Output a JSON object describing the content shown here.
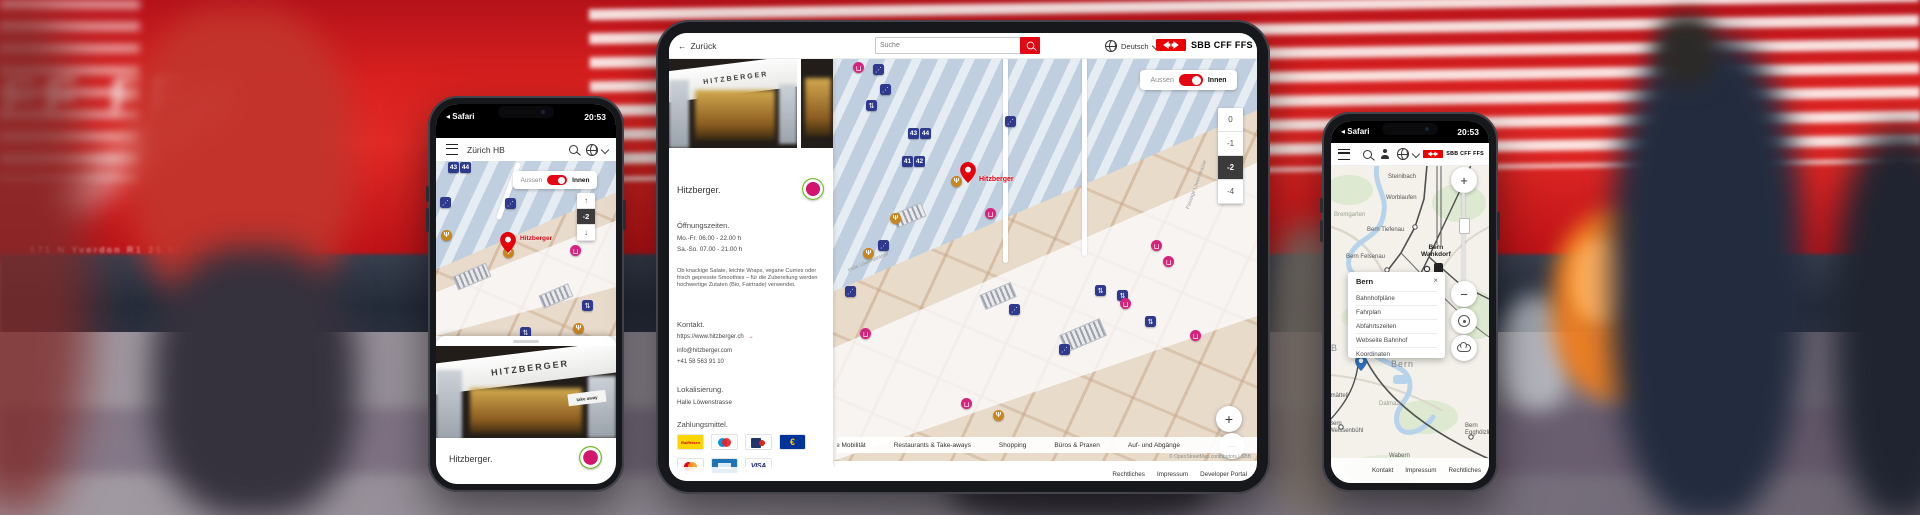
{
  "glyphs": {
    "back": "←",
    "arrow": "→",
    "up": "↑",
    "down": "↓",
    "plus": "+",
    "minus": "−",
    "close": "×",
    "status_back": "◂"
  },
  "background": {
    "train_letters": "FF FF",
    "train_label": "571 N Yverdon R1 25.02.13"
  },
  "phone_left": {
    "status": {
      "app": "Safari",
      "time": "20:53"
    },
    "header": {
      "title": "Zürich HB"
    },
    "map": {
      "toggle_off": "Aussen",
      "toggle_on": "Innen",
      "floor": "-2",
      "pin": "Hitzberger",
      "signs": [
        {
          "v": "43"
        },
        {
          "v": "44"
        }
      ],
      "icons": [
        {
          "type": "esc",
          "x": 4,
          "y": 36
        },
        {
          "type": "esc",
          "x": 69,
          "y": 37
        },
        {
          "type": "resto",
          "x": 5,
          "y": 69
        },
        {
          "type": "resto",
          "x": 67,
          "y": 86
        },
        {
          "type": "shop",
          "x": 134,
          "y": 84
        },
        {
          "type": "lift",
          "x": 146,
          "y": 139
        },
        {
          "type": "resto",
          "x": 137,
          "y": 162
        },
        {
          "type": "lift",
          "x": 84,
          "y": 166
        }
      ]
    },
    "sheet": {
      "sign": "HITZBERGER",
      "tag": "take away",
      "title": "Hitzberger."
    }
  },
  "tablet": {
    "toolbar": {
      "back": "Zurück",
      "search_placeholder": "Suche",
      "language": "Deutsch",
      "logo": "SBB CFF FFS"
    },
    "panel": {
      "sign": "HITZBERGER",
      "title": "Hitzberger.",
      "open_heading": "Öffnungszeiten.",
      "hours": [
        {
          "label": "Mo.-Fr. 06.00 - 22.00 h"
        },
        {
          "label": "Sa.-So. 07.00 - 21.00 h"
        }
      ],
      "description": "Ob knackige Salate, leichte Wraps, vegane Curries oder frisch gepresste Smoothies – für die Zubereitung werden hochwertige Zutaten (Bio, Fairtrade) verwendet.",
      "contact_heading": "Kontakt.",
      "website": "https://www.hitzberger.ch",
      "email": "info@hitzberger.com",
      "phone": "+41 58 563 91 10",
      "location_heading": "Lokalisierung.",
      "location": "Halle Löwenstrasse",
      "payment_heading": "Zahlungsmittel.",
      "payments_row1": [
        {
          "type": "raiffeisen",
          "sym": "Raiffeisen",
          "name": "Raiffeisen"
        },
        {
          "type": "maestro",
          "name": "Maestro"
        },
        {
          "type": "lunchcheck",
          "name": "Lunch-Check"
        },
        {
          "type": "eur",
          "sym": "€",
          "name": "EUR"
        }
      ],
      "payments_row2": [
        {
          "type": "mastercard",
          "name": "Mastercard"
        },
        {
          "type": "amex",
          "name": "American Express"
        },
        {
          "type": "visa",
          "sym": "VISA",
          "name": "VISA"
        }
      ]
    },
    "map": {
      "toggle_off": "Aussen",
      "toggle_on": "Innen",
      "floors": [
        {
          "v": "0"
        },
        {
          "v": "-1"
        },
        {
          "v": "-2",
          "cls": "active"
        },
        {
          "v": "-4"
        }
      ],
      "signs_a": [
        {
          "v": "43"
        },
        {
          "v": "44"
        }
      ],
      "signs_b": [
        {
          "v": "41"
        },
        {
          "v": "42"
        }
      ],
      "pin": "Hitzberger",
      "streets": [
        {
          "text": "Passage Löwenstrasse",
          "x": 352,
          "y": 150,
          "rot": -70
        },
        {
          "text": "Halle Löwenstrasse",
          "x": 14,
          "y": 210,
          "rot": -23
        }
      ],
      "icons": [
        {
          "type": "shop",
          "x": 20,
          "y": 4
        },
        {
          "type": "esc",
          "x": 40,
          "y": 6
        },
        {
          "type": "esc",
          "x": 47,
          "y": 26
        },
        {
          "type": "lift",
          "x": 33,
          "y": 42
        },
        {
          "type": "esc",
          "x": 172,
          "y": 58
        },
        {
          "type": "resto",
          "x": 118,
          "y": 118
        },
        {
          "type": "resto",
          "x": 57,
          "y": 155
        },
        {
          "type": "resto",
          "x": 30,
          "y": 190
        },
        {
          "type": "shop",
          "x": 152,
          "y": 150
        },
        {
          "type": "esc",
          "x": 45,
          "y": 182
        },
        {
          "type": "esc",
          "x": 12,
          "y": 228
        },
        {
          "type": "shop",
          "x": 318,
          "y": 182
        },
        {
          "type": "shop",
          "x": 330,
          "y": 198
        },
        {
          "type": "lift",
          "x": 262,
          "y": 227
        },
        {
          "type": "lift",
          "x": 284,
          "y": 232
        },
        {
          "type": "shop",
          "x": 287,
          "y": 240
        },
        {
          "type": "lift",
          "x": 312,
          "y": 258
        },
        {
          "type": "esc",
          "x": 176,
          "y": 246
        },
        {
          "type": "esc",
          "x": 226,
          "y": 286
        },
        {
          "type": "shop",
          "x": 357,
          "y": 272
        },
        {
          "type": "shop",
          "x": 27,
          "y": 270
        },
        {
          "type": "shop",
          "x": 128,
          "y": 340
        },
        {
          "type": "resto",
          "x": 160,
          "y": 352
        }
      ],
      "legend": [
        {
          "label": "Kombinierte Mobilität",
          "type": "mobility",
          "cls": "clip"
        },
        {
          "label": "Restaurants & Take-aways",
          "type": "resto"
        },
        {
          "label": "Shopping",
          "type": "shop"
        },
        {
          "label": "Büros & Praxen",
          "type": "office"
        },
        {
          "label": "Auf- und Abgänge",
          "type": "stairs"
        }
      ],
      "attribution": "© OpenStreetMap contributors | SBB",
      "footer": [
        {
          "label": "Rechtliches"
        },
        {
          "label": "Impressum"
        },
        {
          "label": "Developer Portal"
        }
      ]
    }
  },
  "phone_right": {
    "status": {
      "app": "Safari",
      "time": "20:53"
    },
    "header": {
      "logo": "SBB CFF FFS"
    },
    "map": {
      "labels": [
        {
          "text": "Steinibach",
          "x": 57,
          "y": 9
        },
        {
          "text": "Worblaufen",
          "x": 55,
          "y": 30
        },
        {
          "text": "Bremgarten",
          "x": 3,
          "y": 47,
          "cls": "dim"
        },
        {
          "text": "Bern Tiefenau",
          "x": 36,
          "y": 62
        },
        {
          "text": "Bern Felsenau",
          "x": 15,
          "y": 89
        },
        {
          "text": "Bern\nWankdorf",
          "x": 90,
          "y": 79,
          "cls": "bold"
        },
        {
          "text": "B",
          "x": 0,
          "y": 180,
          "cls": "big"
        },
        {
          "text": "Bern",
          "x": 60,
          "y": 196,
          "cls": "big"
        },
        {
          "text": "Fischermätteli",
          "x": -20,
          "y": 228
        },
        {
          "text": "Dalmazi",
          "x": 48,
          "y": 236,
          "cls": "dim"
        },
        {
          "text": "Bern\nWeissenbühl",
          "x": -2,
          "y": 256
        },
        {
          "text": "Wabern",
          "x": 58,
          "y": 288
        },
        {
          "text": "Bern\nEgghölzli",
          "x": 134,
          "y": 258
        }
      ],
      "popup": {
        "title": "Bern",
        "items": [
          {
            "label": "Bahnhofpläne"
          },
          {
            "label": "Fahrplan"
          },
          {
            "label": "Abfahrtszeiten"
          },
          {
            "label": "Webseite Bahnhof"
          },
          {
            "label": "Koordinaten"
          }
        ]
      },
      "footer": [
        {
          "label": "Kontakt"
        },
        {
          "label": "Impressum"
        },
        {
          "label": "Rechtliches"
        }
      ]
    }
  }
}
